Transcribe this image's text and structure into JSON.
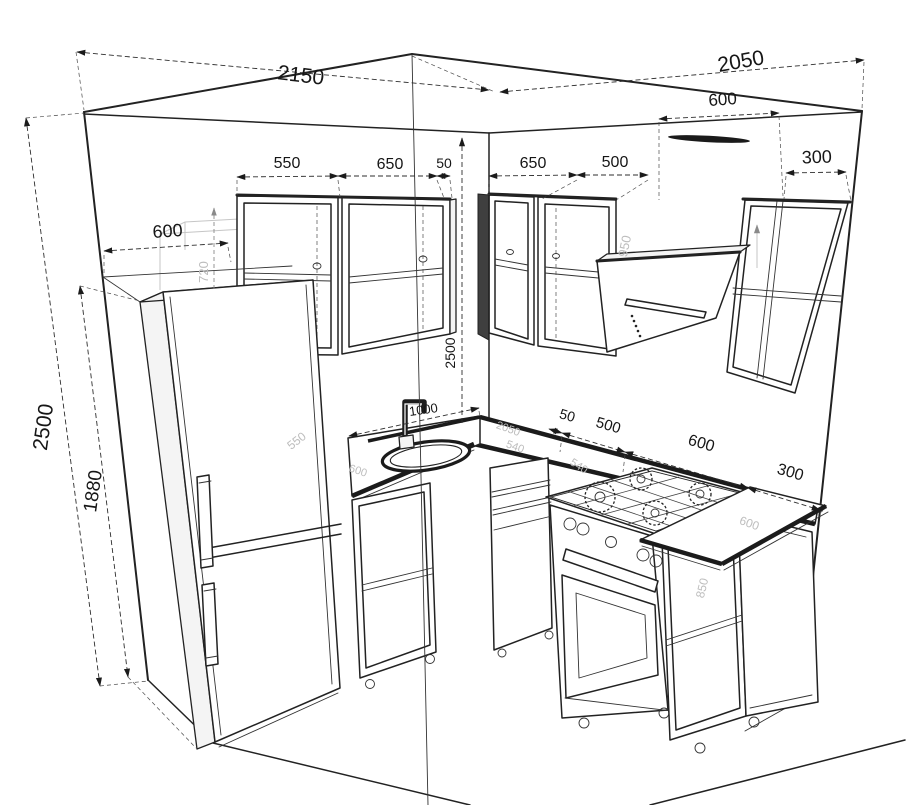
{
  "meta": {
    "description": "CAD perspective line drawing of a corner kitchen with dimension annotations",
    "units": "mm",
    "colors": {
      "background": "#ffffff",
      "ink": "#222222",
      "ghost": "#c6c6c6"
    }
  },
  "dims": {
    "wall_left": "2150",
    "wall_right": "2050",
    "hood_clearance": "600",
    "upper_left_1": "550",
    "upper_left_2": "650",
    "upper_left_gap": "50",
    "upper_right_1": "650",
    "upper_right_2": "500",
    "upper_right_3": "300",
    "fridge_width": "600",
    "room_height": "2500",
    "fridge_height": "1880",
    "corner_height": "2500",
    "sink_offset": "1000",
    "base_gap": "50",
    "base_cabinet": "500",
    "range_width": "600",
    "base_end": "300",
    "ghost_upper_height": "720",
    "ghost_hood_height": "950",
    "ghost_fridge": "550",
    "ghost_counter_len": "2050",
    "ghost_counter_a": "540",
    "ghost_counter_b": "540",
    "ghost_counter_depth_left": "600",
    "ghost_counter_depth_right": "600",
    "ghost_base_height": "850"
  }
}
